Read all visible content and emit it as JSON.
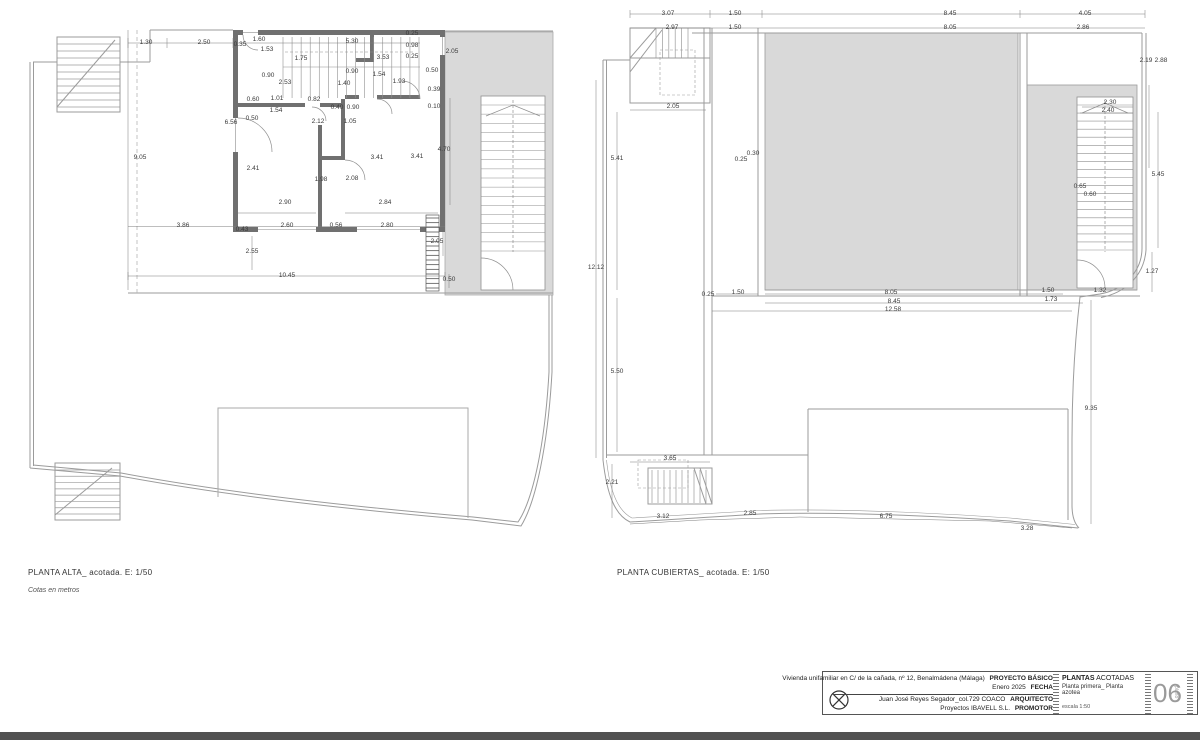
{
  "colors": {
    "roof_fill": "#d9d9d9",
    "wall_fill": "#707070",
    "line": "#9b9b9b",
    "dim_text": "#3a3a3a",
    "bottom_bar": "#515151",
    "sheet_number": "#9a9a9a"
  },
  "left_plan": {
    "title": "PLANTA ALTA_ acotada. E: 1/50",
    "subtitle": "Cotas en metros",
    "dims": [
      {
        "t": "1.30",
        "x": 146,
        "y": 44
      },
      {
        "t": "2.50",
        "x": 204,
        "y": 44
      },
      {
        "t": "0.35",
        "x": 240,
        "y": 46
      },
      {
        "t": "1.60",
        "x": 259,
        "y": 41
      },
      {
        "t": "1.53",
        "x": 267,
        "y": 51
      },
      {
        "t": "5.30",
        "x": 352,
        "y": 43
      },
      {
        "t": "0.25",
        "x": 412,
        "y": 35
      },
      {
        "t": "0.98",
        "x": 412,
        "y": 47
      },
      {
        "t": "0.25",
        "x": 412,
        "y": 58
      },
      {
        "t": "2.05",
        "x": 452,
        "y": 53
      },
      {
        "t": "1.75",
        "x": 301,
        "y": 60
      },
      {
        "t": "3.53",
        "x": 383,
        "y": 59
      },
      {
        "t": "0.90",
        "x": 268,
        "y": 77
      },
      {
        "t": "2.53",
        "x": 285,
        "y": 84
      },
      {
        "t": "0.90",
        "x": 352,
        "y": 73
      },
      {
        "t": "1.54",
        "x": 379,
        "y": 76
      },
      {
        "t": "1.93",
        "x": 399,
        "y": 83
      },
      {
        "t": "1.40",
        "x": 344,
        "y": 85
      },
      {
        "t": "0.50",
        "x": 432,
        "y": 72
      },
      {
        "t": "0.39",
        "x": 434,
        "y": 91
      },
      {
        "t": "0.10",
        "x": 434,
        "y": 108
      },
      {
        "t": "0.60",
        "x": 253,
        "y": 101
      },
      {
        "t": "1.01",
        "x": 277,
        "y": 100
      },
      {
        "t": "0.82",
        "x": 314,
        "y": 101
      },
      {
        "t": "0.40",
        "x": 337,
        "y": 109
      },
      {
        "t": "0.90",
        "x": 353,
        "y": 109
      },
      {
        "t": "1.54",
        "x": 276,
        "y": 112
      },
      {
        "t": "0.50",
        "x": 252,
        "y": 120
      },
      {
        "t": "2.12",
        "x": 318,
        "y": 123
      },
      {
        "t": "1.05",
        "x": 350,
        "y": 123
      },
      {
        "t": "6.56",
        "x": 231,
        "y": 124
      },
      {
        "t": "2.41",
        "x": 253,
        "y": 170
      },
      {
        "t": "1.98",
        "x": 321,
        "y": 181
      },
      {
        "t": "2.08",
        "x": 352,
        "y": 180
      },
      {
        "t": "3.41",
        "x": 377,
        "y": 159
      },
      {
        "t": "3.41",
        "x": 417,
        "y": 158
      },
      {
        "t": "4.70",
        "x": 444,
        "y": 151
      },
      {
        "t": "9.05",
        "x": 140,
        "y": 159
      },
      {
        "t": "2.90",
        "x": 285,
        "y": 204
      },
      {
        "t": "2.84",
        "x": 385,
        "y": 204
      },
      {
        "t": "3.86",
        "x": 183,
        "y": 227
      },
      {
        "t": "0.43",
        "x": 242,
        "y": 231
      },
      {
        "t": "2.60",
        "x": 287,
        "y": 227
      },
      {
        "t": "0.56",
        "x": 336,
        "y": 227
      },
      {
        "t": "2.80",
        "x": 387,
        "y": 227
      },
      {
        "t": "2.05",
        "x": 437,
        "y": 243
      },
      {
        "t": "2.55",
        "x": 252,
        "y": 253
      },
      {
        "t": "10.45",
        "x": 287,
        "y": 277
      },
      {
        "t": "0.50",
        "x": 449,
        "y": 281
      }
    ]
  },
  "right_plan": {
    "title": "PLANTA CUBIERTAS_ acotada. E: 1/50",
    "dims": [
      {
        "t": "3.07",
        "x": 668,
        "y": 15
      },
      {
        "t": "1.50",
        "x": 735,
        "y": 15
      },
      {
        "t": "8.45",
        "x": 950,
        "y": 15
      },
      {
        "t": "4.05",
        "x": 1085,
        "y": 15
      },
      {
        "t": "2.97",
        "x": 672,
        "y": 29
      },
      {
        "t": "1.50",
        "x": 735,
        "y": 29
      },
      {
        "t": "8.05",
        "x": 950,
        "y": 29
      },
      {
        "t": "2.86",
        "x": 1083,
        "y": 29
      },
      {
        "t": "2.19",
        "x": 1146,
        "y": 62
      },
      {
        "t": "2.88",
        "x": 1161,
        "y": 62
      },
      {
        "t": "2.05",
        "x": 673,
        "y": 108
      },
      {
        "t": "2.30",
        "x": 1110,
        "y": 104
      },
      {
        "t": "2.40",
        "x": 1108,
        "y": 112
      },
      {
        "t": "0.30",
        "x": 753,
        "y": 155
      },
      {
        "t": "0.25",
        "x": 741,
        "y": 161
      },
      {
        "t": "5.41",
        "x": 617,
        "y": 160
      },
      {
        "t": "5.45",
        "x": 1158,
        "y": 176
      },
      {
        "t": "0.65",
        "x": 1080,
        "y": 188
      },
      {
        "t": "0.60",
        "x": 1090,
        "y": 196
      },
      {
        "t": "12.12",
        "x": 596,
        "y": 269
      },
      {
        "t": "1.27",
        "x": 1152,
        "y": 273
      },
      {
        "t": "1.32",
        "x": 1100,
        "y": 292
      },
      {
        "t": "1.50",
        "x": 1048,
        "y": 292
      },
      {
        "t": "1.73",
        "x": 1051,
        "y": 301
      },
      {
        "t": "0.25",
        "x": 708,
        "y": 296
      },
      {
        "t": "1.50",
        "x": 738,
        "y": 294
      },
      {
        "t": "8.05",
        "x": 891,
        "y": 294
      },
      {
        "t": "8.45",
        "x": 894,
        "y": 303
      },
      {
        "t": "12.58",
        "x": 893,
        "y": 311
      },
      {
        "t": "5.50",
        "x": 617,
        "y": 373
      },
      {
        "t": "9.35",
        "x": 1091,
        "y": 410
      },
      {
        "t": "3.65",
        "x": 670,
        "y": 460
      },
      {
        "t": "2.21",
        "x": 612,
        "y": 484
      },
      {
        "t": "3.12",
        "x": 663,
        "y": 518
      },
      {
        "t": "2.85",
        "x": 750,
        "y": 515
      },
      {
        "t": "6.75",
        "x": 886,
        "y": 518
      },
      {
        "t": "3.28",
        "x": 1027,
        "y": 530
      }
    ]
  },
  "title_block": {
    "project_line": "Vivienda unifamiliar en C/ de la cañada, nº 12, Benalmádena (Málaga)",
    "project_label": "PROYECTO BÁSICO",
    "date_value": "Enero 2025",
    "date_label": "FECHA",
    "architect_value": "Juan José Reyes Segador_col.729 COACO",
    "architect_label": "ARQUITECTO",
    "promoter_value": "Proyectos IBAVELL S.L.",
    "promoter_label": "PROMOTOR",
    "sheet_title_strong": "PLANTAS",
    "sheet_title_rest": " ACOTADAS",
    "sheet_subtitle": "Planta primera_ Planta azotea",
    "scale_note": "escala 1:50",
    "sheet_number": "06",
    "sheet_number_caption": "plano"
  }
}
